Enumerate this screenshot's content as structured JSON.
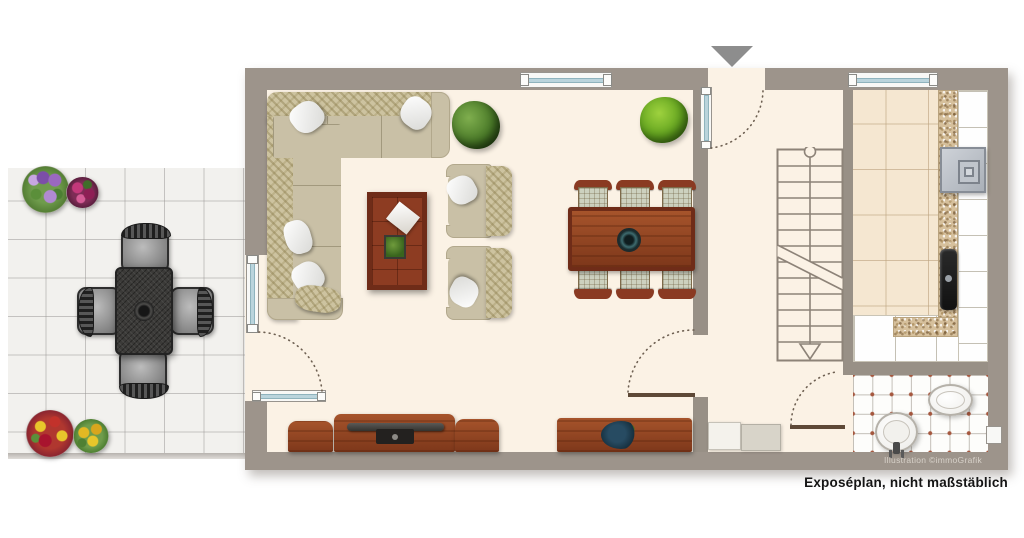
{
  "caption": "Exposéplan, nicht maßstäblich",
  "watermark": "Illustration ©immoGrafik",
  "icons": {
    "entrance_arrow": "triangle-down",
    "stair_direction_arrow": "triangle-down"
  },
  "colors": {
    "wall": "#9d948b",
    "floor": "#fbf2e5",
    "terrace_tile": "#f2f1ee",
    "kitchen_tile": "#f5e7d1",
    "counter_granite": "#d6c09c",
    "wood_furniture": "#93411f",
    "sofa_beige": "#c9c0a6",
    "bath_tile_dot": "#a5573e",
    "window_glass": "#bad4dc",
    "caption_text": "#151515"
  },
  "rooms": {
    "living_room": {
      "furniture": [
        "corner-sofa",
        "coffee-table",
        "armchair",
        "armchair",
        "dining-table",
        "dining-chairs-6",
        "tv-sideboard",
        "sideboard-with-plant",
        "potted-plant",
        "potted-plant"
      ]
    },
    "hallway": {
      "furniture": [
        "shoe-cabinet",
        "bench"
      ]
    },
    "kitchen": {
      "furniture": [
        "l-shaped-counter",
        "stove",
        "sink"
      ]
    },
    "bathroom": {
      "furniture": [
        "toilet",
        "washbasin"
      ],
      "window": "small-side-window"
    },
    "staircase": {
      "direction_arrow": "down"
    },
    "terrace": {
      "furniture": [
        "garden-table",
        "garden-chair",
        "garden-chair",
        "garden-chair",
        "garden-chair",
        "flower-pot",
        "flower-pot",
        "flower-pot",
        "flower-pot"
      ]
    }
  }
}
